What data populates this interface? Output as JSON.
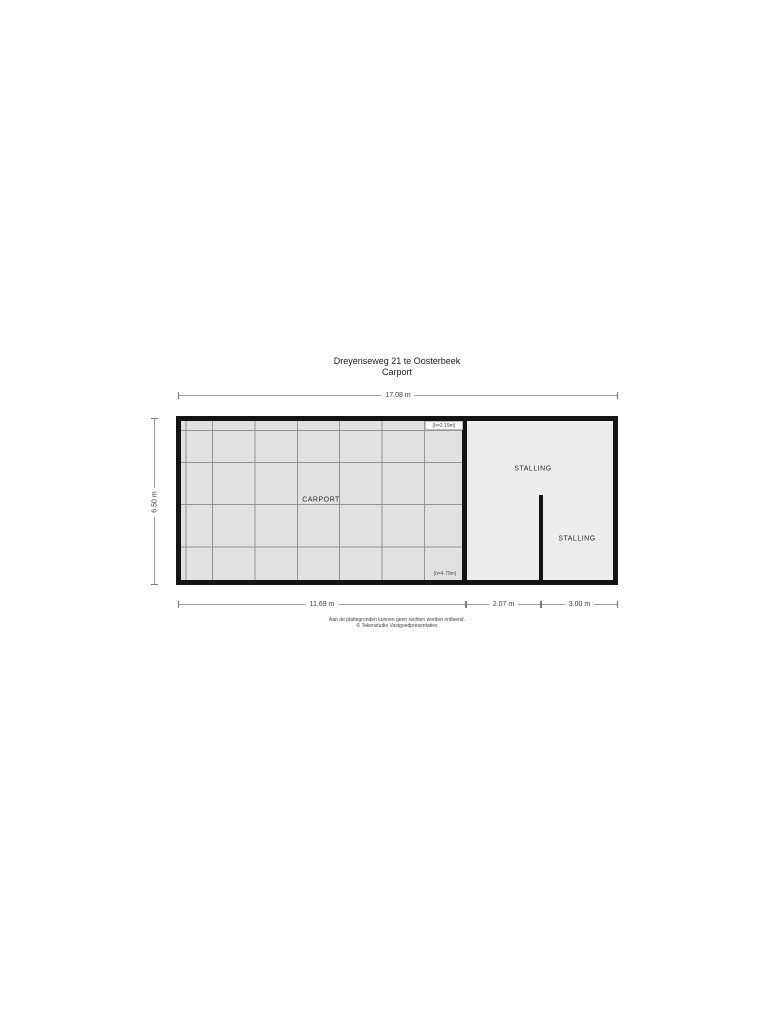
{
  "title": "Dreyenseweg 21 te Oosterbeek",
  "subtitle": "Carport",
  "rooms": {
    "carport": {
      "label": "CARPORT"
    },
    "stalling_1": {
      "label": "STALLING"
    },
    "stalling_2": {
      "label": "STALLING"
    }
  },
  "annotations": {
    "height_note_top": "(h=2.19m)",
    "height_note_bottom": "(h=4.79m)"
  },
  "dimensions": {
    "top_total": "17.08 m",
    "left_height": "6.50 m",
    "bottom_segments": [
      "11.69 m",
      "2.07 m",
      "3.00 m"
    ]
  },
  "footer": {
    "line1": "Aan de plattegronden kunnen geen rechten worden ontleend.",
    "line2": "© Tekenstudio Vastgoedpresentaties"
  },
  "colors": {
    "wall": "#141414",
    "carport_fill": "#e1e1e1",
    "stalling_fill": "#ededed",
    "grid_line": "#959595",
    "dim_line": "#9a9a9a",
    "background": "#ffffff"
  }
}
